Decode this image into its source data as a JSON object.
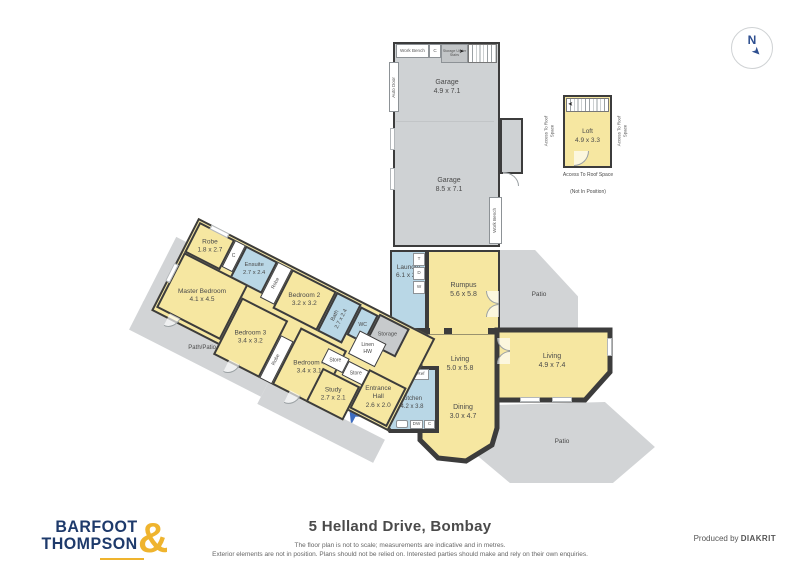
{
  "footer": {
    "title": "5 Helland Drive, Bombay",
    "disclaimer1": "The floor plan is not to scale; measurements are indicative and in metres.",
    "disclaimer2": "Exterior elements are not in position. Plans should not be relied on. Interested parties should make and rely on their own enquiries.",
    "produced_by": "Produced by",
    "producer": "DIAKRIT",
    "logo_line1": "BARFOOT",
    "logo_line2": "THOMPSON",
    "logo_amp": "&"
  },
  "compass": {
    "north": "N"
  },
  "rooms": {
    "garage_upper": {
      "name": "Garage",
      "dims": "4.9 x 7.1"
    },
    "garage_lower": {
      "name": "Garage",
      "dims": "8.5 x 7.1"
    },
    "loft": {
      "name": "Loft",
      "dims": "4.9 x 3.3"
    },
    "laundry": {
      "name": "Laundry",
      "dims": "6.1 x 2.4"
    },
    "rumpus": {
      "name": "Rumpus",
      "dims": "5.6 x 5.8"
    },
    "living1": {
      "name": "Living",
      "dims": "5.0 x 5.8"
    },
    "living2": {
      "name": "Living",
      "dims": "4.9 x 7.4"
    },
    "dining": {
      "name": "Dining",
      "dims": "3.0 x 4.7"
    },
    "kitchen": {
      "name": "Kitchen",
      "dims": "4.2 x 3.8"
    },
    "robe_master": {
      "name": "Robe",
      "dims": "1.8 x 2.7"
    },
    "ensuite": {
      "name": "Ensuite",
      "dims": "2.7 x 2.4"
    },
    "master": {
      "name": "Master Bedroom",
      "dims": "4.1 x 4.5"
    },
    "bedroom2": {
      "name": "Bedroom 2",
      "dims": "3.2 x 3.2"
    },
    "bath": {
      "name": "Bath",
      "dims": "2.7 x 2.4"
    },
    "bedroom3": {
      "name": "Bedroom 3",
      "dims": "3.4 x 3.2"
    },
    "bedroom4": {
      "name": "Bedroom 4",
      "dims": "3.4 x 3.1"
    },
    "study": {
      "name": "Study",
      "dims": "2.7 x 2.1"
    },
    "entrance": {
      "name": "Entrance Hall",
      "dims": "2.6 x 2.0"
    }
  },
  "fixtures": {
    "work_bench": "Work Bench",
    "auto_door": "Auto Door",
    "storage_under_stairs": "Storage Under Stairs",
    "c": "C",
    "t": "T",
    "d": "D",
    "w": "W",
    "p": "P",
    "ref": "Ref",
    "ov": "Ov",
    "dw": "DW",
    "wc": "WC",
    "store": "Store",
    "linen": "Linen",
    "hw": "HW",
    "robe": "Robe",
    "storage": "Storage"
  },
  "outdoor": {
    "patio": "Patio",
    "path_patio": "Path/Patio"
  },
  "loft_notes": {
    "access": "Access To Roof Space",
    "not_in_position": "(Not In Position)"
  },
  "colors": {
    "room_yellow": "#F6E7A1",
    "room_blue": "#B9D7E6",
    "outdoor_gray": "#D2D4D6",
    "wall": "#3C3C3C",
    "logo_navy": "#1E3A6B",
    "logo_gold": "#EFB42E",
    "compass_blue": "#2D4E8F",
    "entry_arrow_blue": "#3D6CC0"
  }
}
